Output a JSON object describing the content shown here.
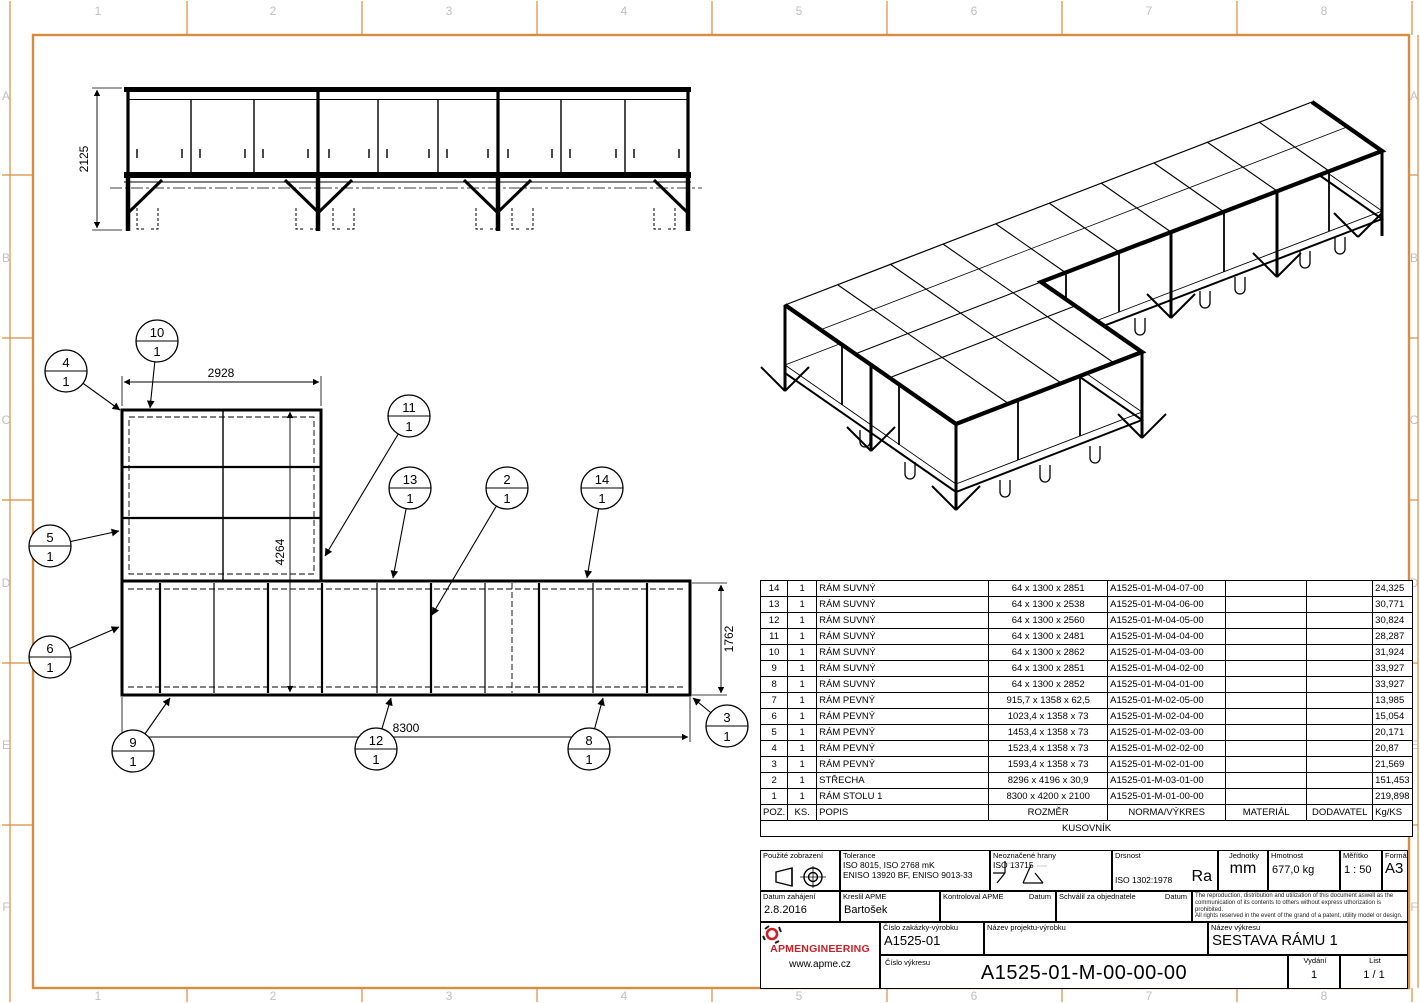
{
  "border": {
    "cols": [
      "1",
      "2",
      "3",
      "4",
      "5",
      "6",
      "7",
      "8"
    ],
    "rows": [
      "A",
      "B",
      "C",
      "D",
      "E",
      "F"
    ]
  },
  "colors": {
    "frame_orange": "#d98c3f",
    "zone_label": "#c4bec4",
    "line": "#000000",
    "logo_red": "#cc2027"
  },
  "front_view": {
    "dim_height": "2125"
  },
  "plan_view": {
    "dims": {
      "top": "2928",
      "left": "4264",
      "right": "1762",
      "bottom": "8300"
    },
    "balloons": [
      {
        "item": "10",
        "qty": "1"
      },
      {
        "item": "4",
        "qty": "1"
      },
      {
        "item": "11",
        "qty": "1"
      },
      {
        "item": "13",
        "qty": "1"
      },
      {
        "item": "2",
        "qty": "1"
      },
      {
        "item": "14",
        "qty": "1"
      },
      {
        "item": "5",
        "qty": "1"
      },
      {
        "item": "6",
        "qty": "1"
      },
      {
        "item": "9",
        "qty": "1"
      },
      {
        "item": "12",
        "qty": "1"
      },
      {
        "item": "8",
        "qty": "1"
      },
      {
        "item": "3",
        "qty": "1"
      }
    ]
  },
  "bom": {
    "title": "KUSOVNÍK",
    "headers": {
      "poz": "POZ.",
      "ks": "KS.",
      "popis": "POPIS",
      "rozmer": "ROZMĚR",
      "norma": "NORMA/VÝKRES",
      "material": "MATERIÁL",
      "dodavatel": "DODAVATEL",
      "kg": "Kg/KS"
    },
    "rows": [
      {
        "poz": "14",
        "ks": "1",
        "popis": "RÁM SUVNÝ",
        "rozmer": "64 x 1300 x 2851",
        "norma": "A1525-01-M-04-07-00",
        "material": "",
        "dodavatel": "",
        "kg": "24,325"
      },
      {
        "poz": "13",
        "ks": "1",
        "popis": "RÁM SUVNÝ",
        "rozmer": "64 x 1300 x 2538",
        "norma": "A1525-01-M-04-06-00",
        "material": "",
        "dodavatel": "",
        "kg": "30,771"
      },
      {
        "poz": "12",
        "ks": "1",
        "popis": "RÁM SUVNÝ",
        "rozmer": "64 x 1300 x 2560",
        "norma": "A1525-01-M-04-05-00",
        "material": "",
        "dodavatel": "",
        "kg": "30,824"
      },
      {
        "poz": "11",
        "ks": "1",
        "popis": "RÁM SUVNÝ",
        "rozmer": "64 x 1300 x 2481",
        "norma": "A1525-01-M-04-04-00",
        "material": "",
        "dodavatel": "",
        "kg": "28,287"
      },
      {
        "poz": "10",
        "ks": "1",
        "popis": "RÁM SUVNÝ",
        "rozmer": "64 x 1300 x 2862",
        "norma": "A1525-01-M-04-03-00",
        "material": "",
        "dodavatel": "",
        "kg": "31,924"
      },
      {
        "poz": "9",
        "ks": "1",
        "popis": "RÁM SUVNÝ",
        "rozmer": "64 x 1300 x 2851",
        "norma": "A1525-01-M-04-02-00",
        "material": "",
        "dodavatel": "",
        "kg": "33,927"
      },
      {
        "poz": "8",
        "ks": "1",
        "popis": "RÁM SUVNÝ",
        "rozmer": "64 x 1300 x 2852",
        "norma": "A1525-01-M-04-01-00",
        "material": "",
        "dodavatel": "",
        "kg": "33,927"
      },
      {
        "poz": "7",
        "ks": "1",
        "popis": "RÁM PEVNÝ",
        "rozmer": "915,7 x 1358 x 62,5",
        "norma": "A1525-01-M-02-05-00",
        "material": "",
        "dodavatel": "",
        "kg": "13,985"
      },
      {
        "poz": "6",
        "ks": "1",
        "popis": "RÁM PEVNÝ",
        "rozmer": "1023,4 x 1358 x 73",
        "norma": "A1525-01-M-02-04-00",
        "material": "",
        "dodavatel": "",
        "kg": "15,054"
      },
      {
        "poz": "5",
        "ks": "1",
        "popis": "RÁM PEVNÝ",
        "rozmer": "1453,4 x 1358 x 73",
        "norma": "A1525-01-M-02-03-00",
        "material": "",
        "dodavatel": "",
        "kg": "20,171"
      },
      {
        "poz": "4",
        "ks": "1",
        "popis": "RÁM PEVNÝ",
        "rozmer": "1523,4 x 1358 x 73",
        "norma": "A1525-01-M-02-02-00",
        "material": "",
        "dodavatel": "",
        "kg": "20,87"
      },
      {
        "poz": "3",
        "ks": "1",
        "popis": "RÁM PEVNÝ",
        "rozmer": "1593,4 x 1358 x 73",
        "norma": "A1525-01-M-02-01-00",
        "material": "",
        "dodavatel": "",
        "kg": "21,569"
      },
      {
        "poz": "2",
        "ks": "1",
        "popis": "STŘECHA",
        "rozmer": "8296 x 4196 x 30,9",
        "norma": "A1525-01-M-03-01-00",
        "material": "",
        "dodavatel": "",
        "kg": "151,453"
      },
      {
        "poz": "1",
        "ks": "1",
        "popis": "RÁM STOLU 1",
        "rozmer": "8300 x 4200 x 2100",
        "norma": "A1525-01-M-01-00-00",
        "material": "",
        "dodavatel": "",
        "kg": "219,898"
      }
    ]
  },
  "title_block": {
    "pouzite_label": "Použité zobrazení",
    "tolerance_label": "Tolerance",
    "tolerance_line1": "ISO 8015, ISO 2768 mK",
    "tolerance_line2": "ENISO 13920 BF, ENISO 9013-33",
    "hrany_label": "Neoznačené hrany",
    "hrany_value": "ISO 13715",
    "drsnost_label": "Drsnost",
    "drsnost_value": "ISO 1302:1978",
    "drsnost_ra": "Ra",
    "jednotky_label": "Jednotky",
    "jednotky_value": "mm",
    "hmotnost_label": "Hmotnost",
    "hmotnost_value": "677,0 kg",
    "meritko_label": "Měřítko",
    "meritko_value": "1 : 50",
    "format_label": "Formát",
    "format_value": "A3",
    "datum_label": "Datum zahájení",
    "datum_value": "2.8.2016",
    "kreslil_label": "Kreslil APME",
    "kreslil_value": "Bartošek",
    "kontroloval_label": "Kontroloval APME",
    "kontroloval_datum": "Datum",
    "schvalil_label": "Schválil za objednatele",
    "schvalil_datum": "Datum",
    "copyright_line1": "The reproduction, distribution and utilization of this document aswell as the",
    "copyright_line2": "communication of its contents to others without express uthorization is prohibited.",
    "copyright_line3": "All rights reserved in the event of the grand of a patent, utility model or design.",
    "logo_text": "APMENGINEERING",
    "logo_url": "www.apme.cz",
    "zakazka_label": "Číslo zakázky-výrobku",
    "zakazka_value": "A1525-01",
    "projekt_label": "Název projektu-výrobku",
    "nazev_label": "Název výkresu",
    "nazev_value": "SESTAVA RÁMU 1",
    "cislo_vykresu_label": "Číslo výkresu",
    "cislo_vykresu_value": "A1525-01-M-00-00-00",
    "vydani_label": "Vydání",
    "vydani_value": "1",
    "list_label": "List",
    "list_value": "1 / 1"
  }
}
